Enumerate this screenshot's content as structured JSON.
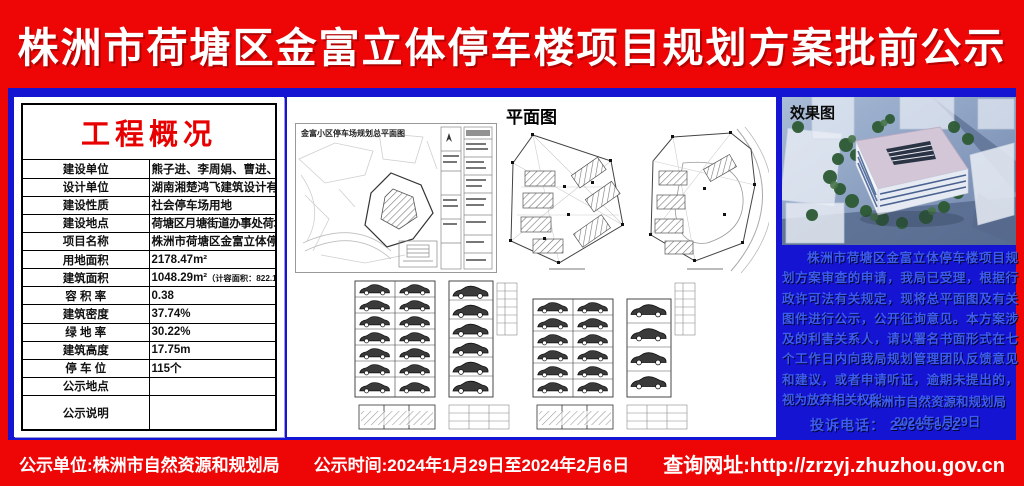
{
  "banner": {
    "title": "株洲市荷塘区金富立体停车楼项目规划方案批前公示"
  },
  "overview": {
    "title": "工程概况",
    "rows": [
      {
        "label": "建设单位",
        "value": "熊子进、李周娟、曹进、周正桃、吴昊、王家旺"
      },
      {
        "label": "设计单位",
        "value": "湖南湘楚鸿飞建筑设计有限公司、甲级"
      },
      {
        "label": "建设性质",
        "value": "社会停车场用地"
      },
      {
        "label": "建设地点",
        "value": "荷塘区月塘街道办事处荷塘铺村规划JC73路与JC76路交汇处以南"
      },
      {
        "label": "项目名称",
        "value": "株洲市荷塘区金富立体停车楼"
      },
      {
        "label": "用地面积",
        "value": "2178.47m²"
      },
      {
        "label": "建筑面积",
        "value": "1048.29m²",
        "note": "（计容面积：822.16m²，不计容面积：226.13m²）"
      },
      {
        "label": "容 积 率",
        "value": "0.38"
      },
      {
        "label": "建筑密度",
        "value": "37.74%"
      },
      {
        "label": "绿 地 率",
        "value": "30.22%"
      },
      {
        "label": "建筑高度",
        "value": "17.75m"
      },
      {
        "label": "停 车 位",
        "value": "115个"
      },
      {
        "label": "公示地点",
        "value": ""
      },
      {
        "label": "公示说明",
        "value": ""
      }
    ]
  },
  "plan": {
    "title": "平面图",
    "site_plan_caption": "金富小区停车场规划总平面图"
  },
  "render_panel": {
    "label": "效果图",
    "notice": "株洲市荷塘区金富立体停车楼项目规划方案审查的申请，我局已受理，根据行政许可法有关规定，现将总平面图及有关图件进行公示，公开征询意见。本方案涉及的利害关系人，请以署名书面形式在七个工作日内向我局规划管理团队反馈意见和建议，或者申请听证，逾期未提出的，视为放弃相关权利。",
    "phone": "投诉电话： 28685032",
    "signature": "株洲市自然资源和规划局",
    "date": "2024年1月29日"
  },
  "footer": {
    "unit": "公示单位:株洲市自然资源和规划局",
    "time": "公示时间:2024年1月29日至2024年2月6日",
    "url": "查询网址:http://zrzyj.zhuzhou.gov.cn"
  },
  "colors": {
    "banner_red": "#ee0606",
    "background_blue": "#1414d2",
    "overview_title_red": "#e80000",
    "notice_text_blue": "#3d5cf2"
  }
}
